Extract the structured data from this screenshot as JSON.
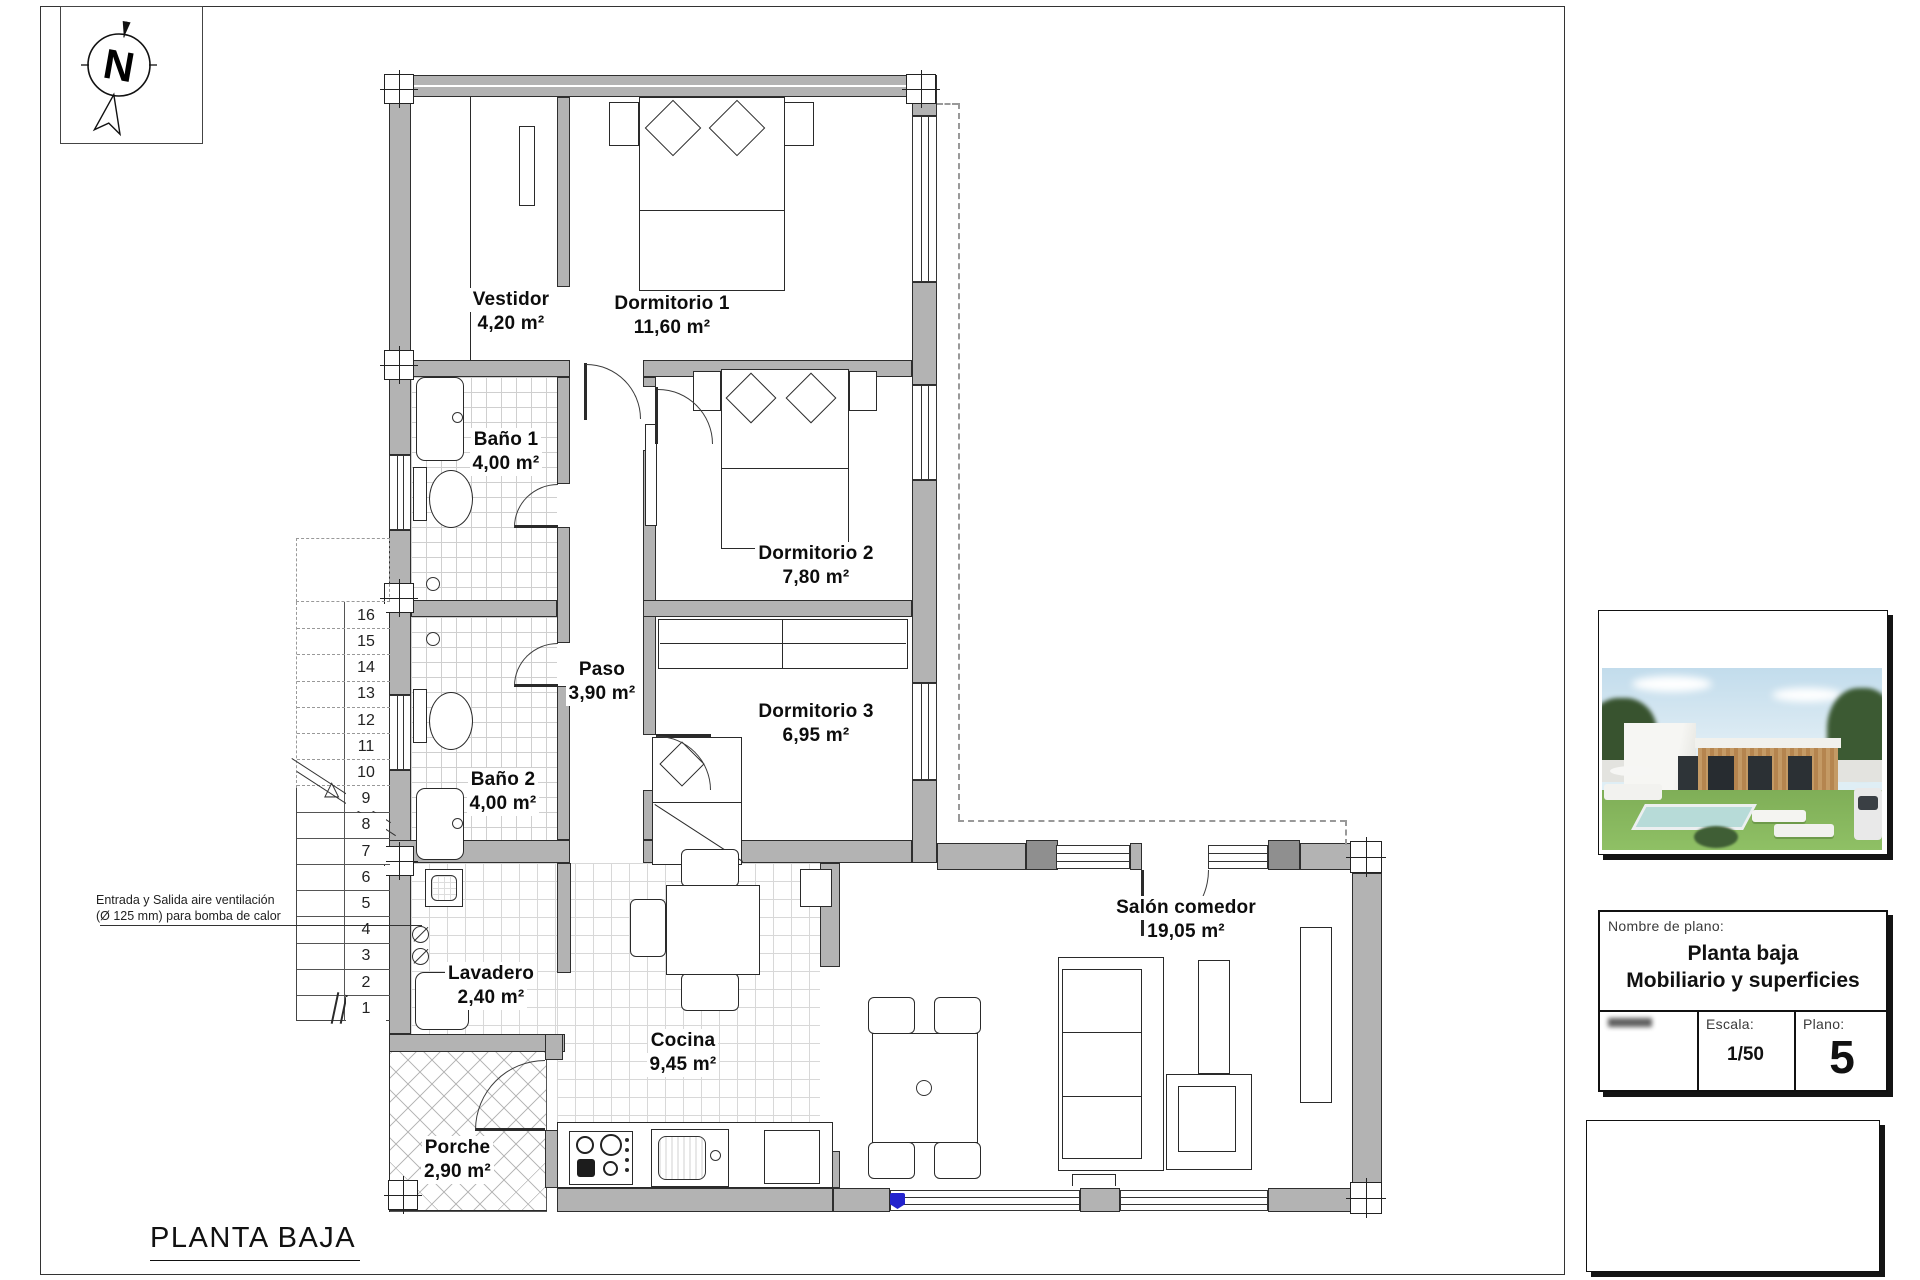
{
  "drawing": {
    "title": "PLANTA BAJA",
    "north_label": "N"
  },
  "rooms": {
    "vestidor": {
      "name": "Vestidor",
      "area": "4,20 m²"
    },
    "dormitorio1": {
      "name": "Dormitorio 1",
      "area": "11,60 m²"
    },
    "bano1": {
      "name": "Baño 1",
      "area": "4,00 m²"
    },
    "dormitorio2": {
      "name": "Dormitorio 2",
      "area": "7,80 m²"
    },
    "paso": {
      "name": "Paso",
      "area": "3,90 m²"
    },
    "dormitorio3": {
      "name": "Dormitorio 3",
      "area": "6,95 m²"
    },
    "bano2": {
      "name": "Baño 2",
      "area": "4,00 m²"
    },
    "lavadero": {
      "name": "Lavadero",
      "area": "2,40 m²"
    },
    "cocina": {
      "name": "Cocina",
      "area": "9,45 m²"
    },
    "porche": {
      "name": "Porche",
      "area": "2,90 m²"
    },
    "salon": {
      "name": "Salón comedor",
      "area": "19,05 m²"
    }
  },
  "annotation": {
    "line1": "Entrada y Salida aire ventilación",
    "line2": "(Ø 125 mm) para bomba de calor"
  },
  "stairs": {
    "numbers": [
      "16",
      "15",
      "14",
      "13",
      "12",
      "11",
      "10",
      "9",
      "8",
      "7",
      "6",
      "5",
      "4",
      "3",
      "2",
      "1"
    ]
  },
  "title_block": {
    "name_label": "Nombre de plano:",
    "plan_name_line1": "Planta baja",
    "plan_name_line2": "Mobiliario y superficies",
    "escala_label": "Escala:",
    "escala_value": "1/50",
    "plano_label": "Plano:",
    "plano_value": "5"
  },
  "colors": {
    "wall_gray": "#b3b3b3",
    "wall_dark": "#8f8f8f",
    "line": "#2a2a2a",
    "dash_gray": "#999999",
    "accent_blue": "#2323cd"
  }
}
